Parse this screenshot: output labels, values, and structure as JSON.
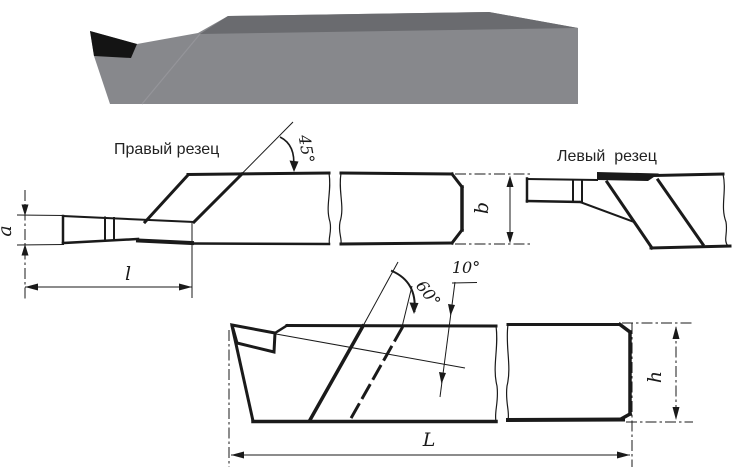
{
  "labels": {
    "right_cutter": "Правый резец",
    "left_cutter": "Левый  резец",
    "angle_45": "45°",
    "angle_60": "60°",
    "angle_10": "10°",
    "dim_a": "a",
    "dim_b": "b",
    "dim_l": "l",
    "dim_h": "h",
    "dim_L": "L"
  },
  "colors": {
    "line": "#1a1a1a",
    "text": "#222222",
    "tool_front_face": "#87888c",
    "tool_top_face": "#6a6b6f",
    "tool_tip": "#141414",
    "background": "#ffffff"
  }
}
